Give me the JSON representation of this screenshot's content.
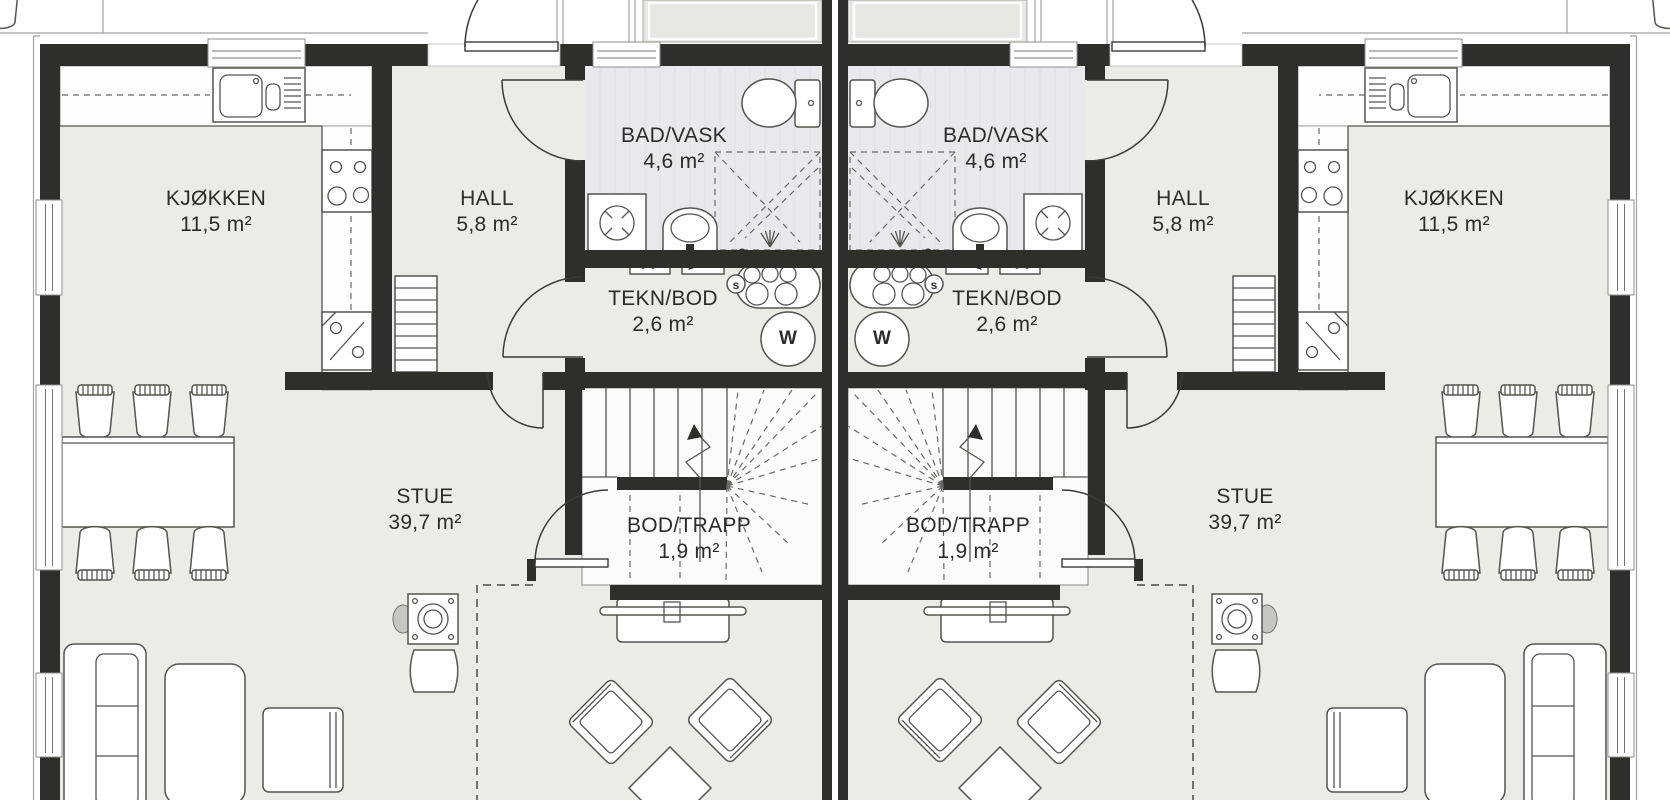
{
  "rooms": {
    "kjokken": {
      "name": "KJØKKEN",
      "area": "11,5 m²"
    },
    "hall": {
      "name": "HALL",
      "area": "5,8 m²"
    },
    "bad": {
      "name": "BAD/VASK",
      "area": "4,6 m²"
    },
    "tekn": {
      "name": "TEKN/BOD",
      "area": "2,6 m²"
    },
    "stue": {
      "name": "STUE",
      "area": "39,7 m²"
    },
    "bod": {
      "name": "BOD/TRAPP",
      "area": "1,9 m²"
    }
  },
  "fixtures": {
    "water_heater": "W",
    "shunt_valve": "s"
  },
  "colors": {
    "wall": "#2f2e2b",
    "floor": "#edebe6",
    "bath-floor": "#e9e9ed",
    "porch-floor": "#e8e6e1",
    "stairs-floor": "#fbfbf9",
    "line": "#56544f"
  }
}
